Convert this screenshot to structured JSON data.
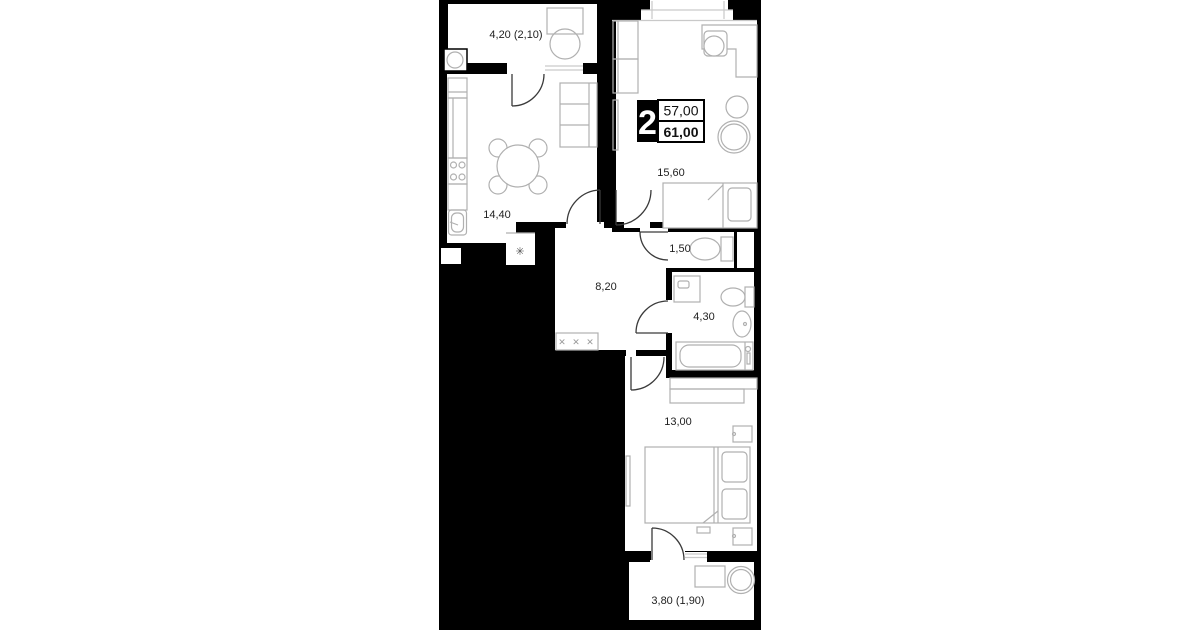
{
  "unit_card": {
    "rooms_count": "2",
    "area_top": "57,00",
    "area_bottom": "61,00"
  },
  "rooms": {
    "balcony_top": {
      "name": "balcony",
      "area_label": "4,20 (2,10)"
    },
    "kitchen": {
      "name": "kitchen",
      "area_label": "14,40"
    },
    "living_room": {
      "name": "living-room",
      "area_label": "15,60"
    },
    "toilet": {
      "name": "toilet",
      "area_label": "1,50"
    },
    "hallway": {
      "name": "hallway",
      "area_label": "8,20"
    },
    "bathroom": {
      "name": "bathroom",
      "area_label": "4,30"
    },
    "bedroom": {
      "name": "bedroom",
      "area_label": "13,00"
    },
    "balcony_bottom": {
      "name": "balcony",
      "area_label": "3,80 (1,90)"
    }
  },
  "symbols": {
    "radiator": "✳",
    "wardrobe_marks": "✕ ✕ ✕"
  },
  "colors": {
    "wall": "#000000",
    "floor": "#ffffff",
    "furniture_outline": "#b0b0b0",
    "door": "#3a3a3a",
    "label_text": "#1f1f1f",
    "badge_bg": "#000000",
    "badge_text": "#ffffff"
  }
}
